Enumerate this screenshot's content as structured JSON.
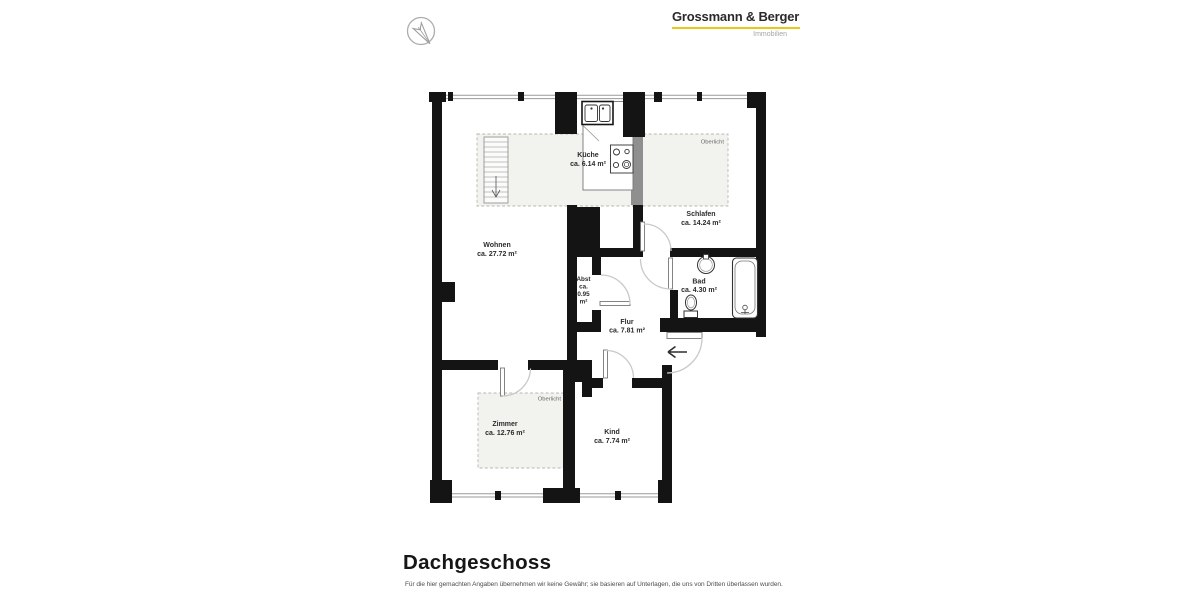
{
  "brand": {
    "name": "Grossmann & Berger",
    "division": "Immobilien",
    "underline_color": "#EAC51C",
    "compass_letter": "N"
  },
  "plan": {
    "skylight_label": "Oberlicht",
    "colors": {
      "wall": "#141414",
      "skylight_fill": "#F2F2EF",
      "door_arc": "#C9C9C9"
    },
    "rooms": {
      "wohnen": {
        "name": "Wohnen",
        "area": "ca. 27.72 m²"
      },
      "kueche": {
        "name": "Küche",
        "area": "ca. 6.14 m²"
      },
      "schlafen": {
        "name": "Schlafen",
        "area": "ca. 14.24 m²"
      },
      "bad": {
        "name": "Bad",
        "area": "ca. 4.30 m²"
      },
      "flur": {
        "name": "Flur",
        "area": "ca. 7.81 m²"
      },
      "abst": {
        "name": "Abst",
        "line2": "ca.",
        "line3": "0.95",
        "line4": "m²"
      },
      "zimmer": {
        "name": "Zimmer",
        "area": "ca. 12.76 m²"
      },
      "kind": {
        "name": "Kind",
        "area": "ca. 7.74 m²"
      }
    }
  },
  "footer": {
    "title": "Dachgeschoss",
    "disclaimer": "Für die hier gemachten Angaben übernehmen wir keine Gewähr; sie basieren auf Unterlagen, die uns von Dritten überlassen wurden."
  }
}
